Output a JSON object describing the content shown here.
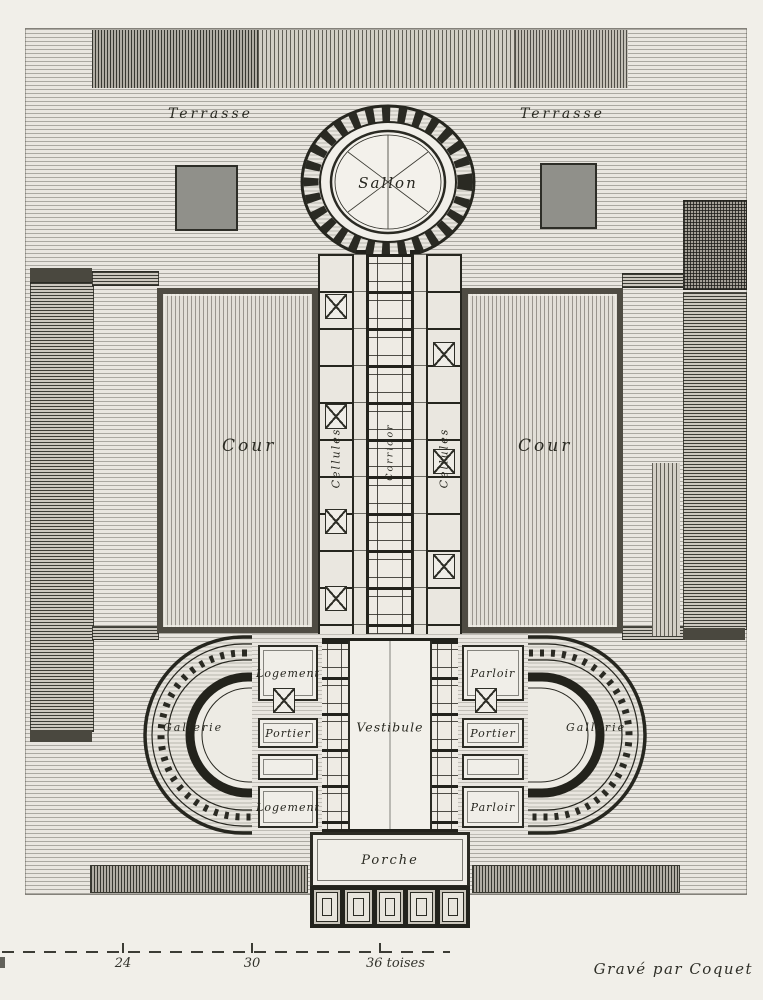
{
  "plate": {
    "credit": "Gravé par Coquet"
  },
  "labels": {
    "terrasse_left": "Terrasse",
    "terrasse_right": "Terrasse",
    "sallon": "Sallon",
    "cour_left": "Cour",
    "cour_right": "Cour",
    "cellules_left": "Cellules",
    "cellules_right": "Cellules",
    "corridor": "Corridor",
    "logement_top": "Logement",
    "parloir_top": "Parloir",
    "portier_left": "Portier",
    "portier_right": "Portier",
    "vestibule": "Vestibule",
    "gallerie_left": "Gallerie",
    "gallerie_right": "Gallerie",
    "logement_bottom": "Logement",
    "parloir_bottom": "Parloir",
    "porche": "Porche"
  },
  "scale_bar": {
    "tick_24": "24",
    "tick_30": "30",
    "end_label": "36 toises"
  },
  "colors": {
    "paper": "#e9e6e0",
    "ink": "#26261f",
    "parterre_gray": "#90908a"
  }
}
